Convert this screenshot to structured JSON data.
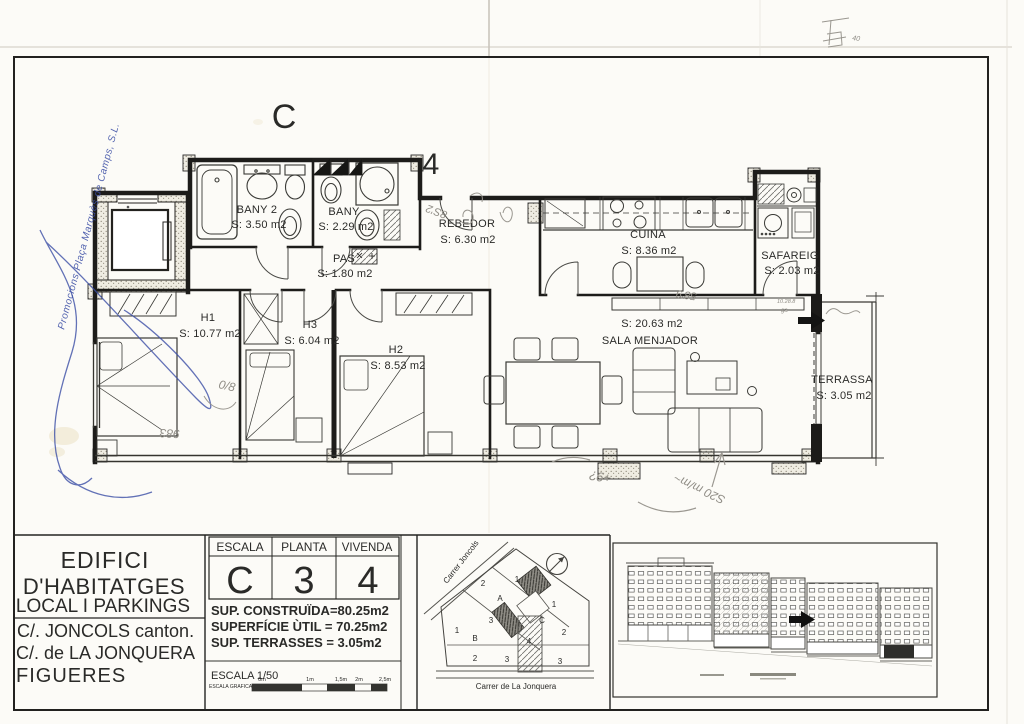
{
  "plan": {
    "block_letter": "C",
    "unit_number": "4",
    "rooms": {
      "bany2": {
        "name": "BANY 2",
        "area": "S: 3.50 m2"
      },
      "bany": {
        "name": "BANY",
        "area": "S: 2.29 m2"
      },
      "pas": {
        "name": "PAS",
        "area": "S: 1.80 m2"
      },
      "rebedor": {
        "name": "REBEDOR",
        "area": "S: 6.30 m2"
      },
      "cuina": {
        "name": "CUINA",
        "area": "S: 8.36 m2"
      },
      "safareig": {
        "name": "SAFAREIG",
        "area": "S: 2.03 m2"
      },
      "h1": {
        "name": "H1",
        "area": "S: 10.77 m2"
      },
      "h3": {
        "name": "H3",
        "area": "S: 6.04 m2"
      },
      "h2": {
        "name": "H2",
        "area": "S: 8.53 m2"
      },
      "sala": {
        "name": "SALA  MENJADOR",
        "area": "S: 20.63 m2"
      },
      "terrassa": {
        "name": "TERRASSA",
        "area": "S: 3.05 m2"
      }
    },
    "handwriting": {
      "corner_mark": "40",
      "note_rebedor": "8S'2",
      "note_kitchen_wall": "58'9",
      "note_h1": "0/8",
      "note_h1_bottom": "983",
      "note_bottom_1": "+9?",
      "note_bottom_2": "S20 m/m~",
      "note_terrace_small_1": "10.28.8",
      "note_terrace_small_2": "ga"
    },
    "stamp_text": "Promocions Plaça Marquès de Camps, S.L."
  },
  "titleblock": {
    "building_title_1": "EDIFICI",
    "building_title_2": "D'HABITATGES",
    "building_title_3": "LOCAL I PARKINGS",
    "address_1": "C/. JONCOLS canton.",
    "address_2": "C/. de LA JONQUERA",
    "address_3": "FIGUERES",
    "escala_label": "ESCALA",
    "escala_value": "C",
    "planta_label": "PLANTA",
    "planta_value": "3",
    "vivenda_label": "VIVENDA",
    "vivenda_value": "4",
    "sup_construida": "SUP. CONSTRUÏDA=80.25m2",
    "sup_util": "SUPERFÍCIE ÙTIL  = 70.25m2",
    "sup_terrasses": "SUP. TERRASSES  = 3.05m2",
    "scale_text": "ESCALA 1/50",
    "scale_bar_caption": "ESCALA GRAFICA",
    "scale_tick_0": "0m",
    "scale_tick_1": "1m",
    "scale_tick_2": "1,5m",
    "scale_tick_3": "2m",
    "scale_tick_4": "2,5m"
  },
  "siteplan": {
    "street_joncols": "Carrer Joncols",
    "street_jonquera": "Carrer de La Jonquera",
    "plots": {
      "a": "A",
      "b": "B",
      "c": "C",
      "u4": "4",
      "n1a": "1",
      "n1b": "1",
      "n1c": "1",
      "n2a": "2",
      "n2b": "2",
      "n2c": "2",
      "n3a": "3",
      "n3b": "3",
      "n3c": "3"
    }
  }
}
